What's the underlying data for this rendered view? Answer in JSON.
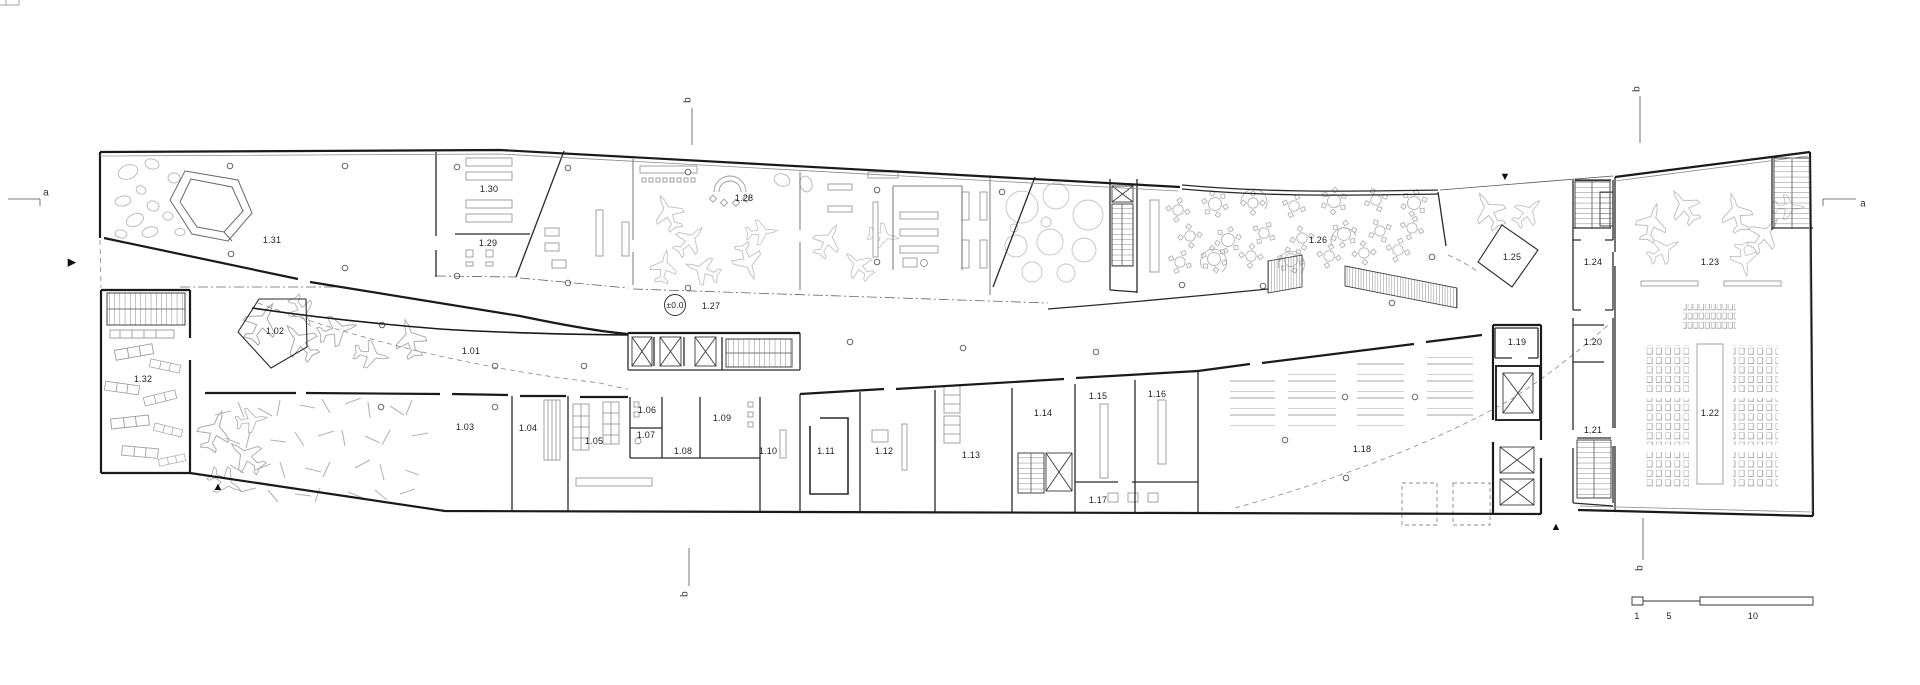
{
  "drawing": {
    "type_label": "first-floor-plan"
  },
  "rooms": [
    {
      "id": "1.01",
      "x": 471,
      "y": 351
    },
    {
      "id": "1.02",
      "x": 275,
      "y": 331
    },
    {
      "id": "1.03",
      "x": 465,
      "y": 427
    },
    {
      "id": "1.04",
      "x": 528,
      "y": 428
    },
    {
      "id": "1.05",
      "x": 594,
      "y": 441
    },
    {
      "id": "1.06",
      "x": 647,
      "y": 410
    },
    {
      "id": "1.07",
      "x": 646,
      "y": 435
    },
    {
      "id": "1.08",
      "x": 683,
      "y": 451
    },
    {
      "id": "1.09",
      "x": 722,
      "y": 418
    },
    {
      "id": "1.10",
      "x": 768,
      "y": 451
    },
    {
      "id": "1.11",
      "x": 826,
      "y": 451
    },
    {
      "id": "1.12",
      "x": 884,
      "y": 451
    },
    {
      "id": "1.13",
      "x": 971,
      "y": 455
    },
    {
      "id": "1.14",
      "x": 1043,
      "y": 413
    },
    {
      "id": "1.15",
      "x": 1098,
      "y": 396
    },
    {
      "id": "1.16",
      "x": 1157,
      "y": 394
    },
    {
      "id": "1.17",
      "x": 1098,
      "y": 500
    },
    {
      "id": "1.18",
      "x": 1362,
      "y": 449
    },
    {
      "id": "1.19",
      "x": 1517,
      "y": 342
    },
    {
      "id": "1.20",
      "x": 1593,
      "y": 342
    },
    {
      "id": "1.21",
      "x": 1593,
      "y": 430
    },
    {
      "id": "1.22",
      "x": 1710,
      "y": 413
    },
    {
      "id": "1.23",
      "x": 1710,
      "y": 262
    },
    {
      "id": "1.24",
      "x": 1593,
      "y": 262
    },
    {
      "id": "1.25",
      "x": 1512,
      "y": 257
    },
    {
      "id": "1.26",
      "x": 1318,
      "y": 240
    },
    {
      "id": "1.27",
      "x": 711,
      "y": 306
    },
    {
      "id": "1.28",
      "x": 744,
      "y": 198
    },
    {
      "id": "1.29",
      "x": 488,
      "y": 243
    },
    {
      "id": "1.30",
      "x": 489,
      "y": 189
    },
    {
      "id": "1.31",
      "x": 272,
      "y": 240
    },
    {
      "id": "1.32",
      "x": 143,
      "y": 379
    }
  ],
  "level_marker": {
    "label": "±0.0",
    "x": 675,
    "y": 305
  },
  "section_markers": [
    {
      "label": "a",
      "x": 46,
      "y": 193,
      "rot": false
    },
    {
      "label": "a",
      "x": 1863,
      "y": 204,
      "rot": false
    },
    {
      "label": "b",
      "x": 688,
      "y": 100,
      "rot": true
    },
    {
      "label": "b",
      "x": 1637,
      "y": 89,
      "rot": true
    },
    {
      "label": "b",
      "x": 685,
      "y": 594,
      "rot": true
    },
    {
      "label": "b",
      "x": 1640,
      "y": 568,
      "rot": true
    }
  ],
  "arrows": [
    {
      "name": "entrance-arrow-left",
      "glyph": "▶",
      "x": 72,
      "y": 262
    },
    {
      "name": "entrance-arrow-top",
      "glyph": "▼",
      "x": 1505,
      "y": 177
    },
    {
      "name": "entrance-arrow-bottom-left",
      "glyph": "▲",
      "x": 218,
      "y": 487
    },
    {
      "name": "entrance-arrow-bottom-right",
      "glyph": "▲",
      "x": 1556,
      "y": 527
    }
  ],
  "scale_bar": {
    "labels": [
      {
        "text": "1",
        "x": 1637,
        "y": 616
      },
      {
        "text": "5",
        "x": 1669,
        "y": 616
      },
      {
        "text": "10",
        "x": 1753,
        "y": 616
      }
    ]
  },
  "colors": {
    "wall": "#1c1c1c",
    "furniture": "#9a9a9a",
    "faint": "#c4c4c4",
    "background": "#ffffff"
  }
}
